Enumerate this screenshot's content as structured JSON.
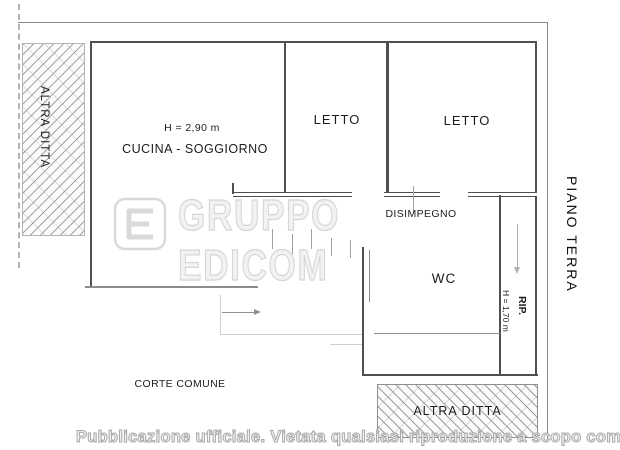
{
  "document": {
    "type": "floor-plan"
  },
  "labels": {
    "altra_ditta_left": "ALTRA DITTA",
    "ceiling_height_main": "H = 2,90 m",
    "kitchen_living": "CUCINA - SOGGIORNO",
    "bedroom_1": "LETTO",
    "bedroom_2": "LETTO",
    "hallway": "DISIMPEGNO",
    "wc": "WC",
    "storage": "RIP.",
    "ceiling_height_storage": "H = 1,70 m",
    "floor_name": "PIANO TERRA",
    "courtyard": "CORTE COMUNE",
    "altra_ditta_bottom": "ALTRA DITTA"
  },
  "watermark": {
    "logo": "edicom-logo",
    "text": "GRUPPO EDICOM"
  },
  "footer": {
    "text": "Pubblicazione ufficiale. Vietata qualsiasi riproduzione a scopo commerciale"
  },
  "colors": {
    "wall": "#4f4f4f",
    "outer_line": "#8a8a8a",
    "light_line": "#cfcfcf",
    "hatch": "#b0b0b0",
    "watermark_outline": "#d6d6d6",
    "footer_text": "#a8a8a8",
    "label_text": "#1c1c1c"
  }
}
